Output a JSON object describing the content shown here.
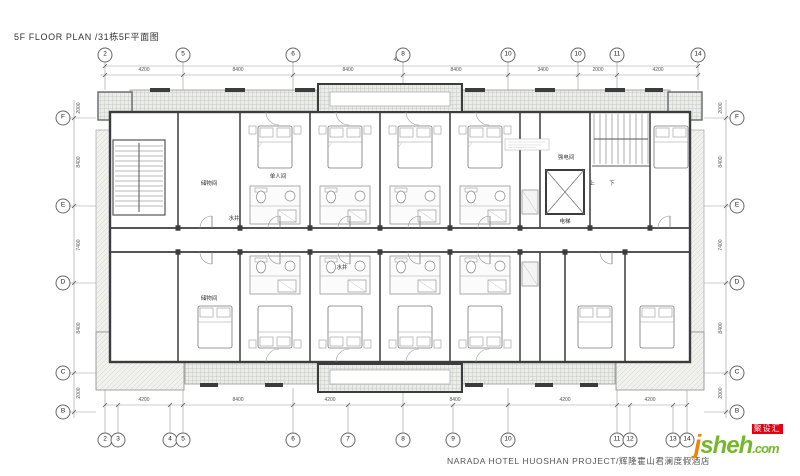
{
  "title": "5F FLOOR PLAN /31栋5F平面图",
  "footer": "NARADA HOTEL HUOSHAN PROJECT/辉隆霍山君澜度假酒店",
  "watermark": {
    "logo_j": "j",
    "logo_rest": "sheh",
    "logo_tld": ".com",
    "badge": "聚设汇"
  },
  "grid": {
    "top": [
      "2",
      "5",
      "6",
      "8",
      "10",
      "10",
      "11",
      "14"
    ],
    "bottom": [
      "2",
      "3",
      "4",
      "5",
      "6",
      "7",
      "8",
      "9",
      "10",
      "11",
      "12",
      "13",
      "14"
    ],
    "left": [
      "F",
      "E",
      "D",
      "C",
      "B"
    ],
    "right": [
      "F",
      "E",
      "D",
      "C",
      "B"
    ]
  },
  "dims": {
    "top_total": "43400",
    "top": [
      "4200",
      "8400",
      "8400",
      "8400",
      "3400",
      "2000",
      "4200"
    ],
    "bottom": [
      "4200",
      "8400",
      "4200",
      "8400",
      "4200",
      "4200"
    ],
    "left": [
      "2000",
      "8400",
      "7400",
      "8400",
      "2000"
    ],
    "right": [
      "2000",
      "8400",
      "7400",
      "8400",
      "2000"
    ]
  },
  "rooms": {
    "storage_top": "储物间",
    "storage_bottom": "储物间",
    "single": "单人间",
    "shaft_top": "水井",
    "shaft_bottom": "水井",
    "elec": "强电间",
    "elevator": "电梯",
    "up": "上",
    "down": "下"
  }
}
